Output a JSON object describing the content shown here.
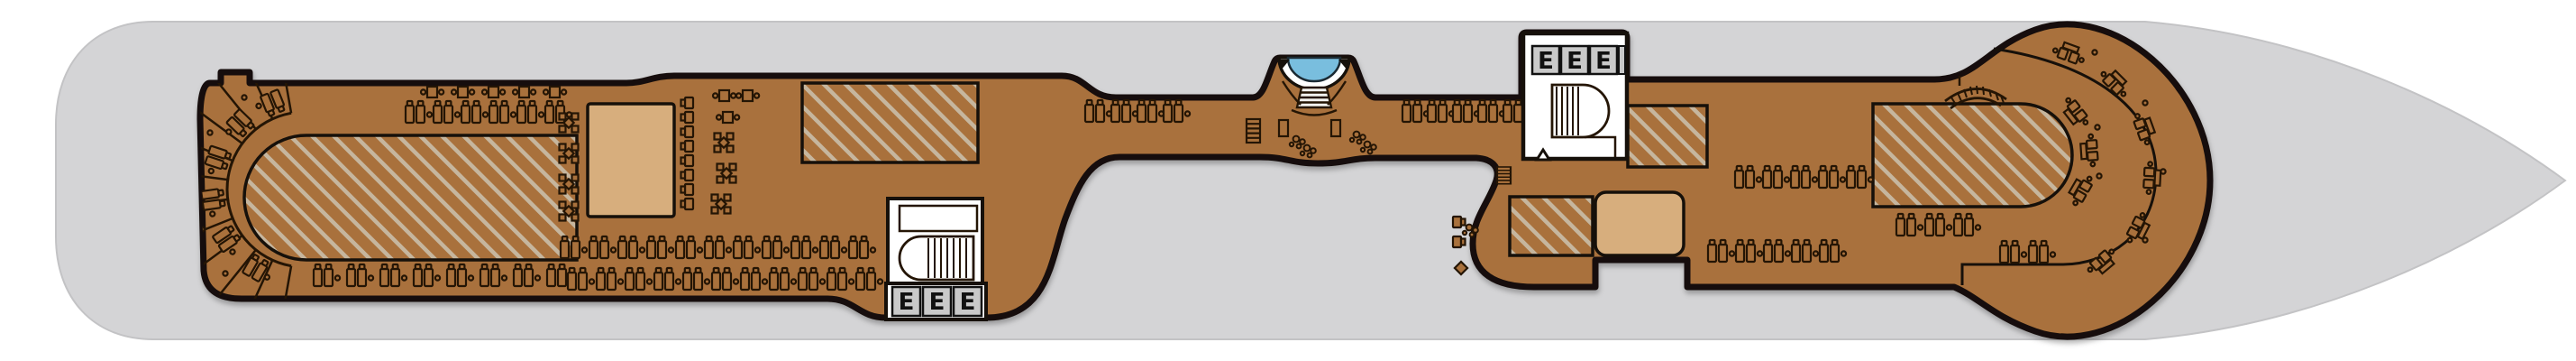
{
  "page": {
    "kind": "cruise-ship-deck-plan",
    "background": "#ffffff"
  },
  "colors": {
    "hull": "#d4d4d6",
    "hull_edge": "#c3c3c5",
    "deck_wood": "#a9713c",
    "deck_outline": "#16100a",
    "hatch_stripe": "#c6b69e",
    "structure_tan": "#d7ae7d",
    "stairwell_white": "#ffffff",
    "elevator_cell": "#c9c9c9",
    "elevator_letter": "#111111",
    "pool_water": "#79bede",
    "pool_rim": "#ffffff",
    "icon_line": "#241505"
  },
  "elevators": {
    "label": "E",
    "banks": [
      {
        "id": "aft-elevator-bank",
        "cells": 3
      },
      {
        "id": "forward-elevator-bank",
        "cells": 3
      }
    ]
  },
  "pool": {
    "shape": "semicircular",
    "has_steps": true
  },
  "counts": {
    "hatched_sun_areas": 6,
    "tan_structures": 2,
    "spiral_stairwells": 2,
    "sun_lounger_rows": 10,
    "fan_step_terraces": 1
  },
  "icon_names": {
    "sun-lounger-pair-icon": "two sunbeds with side-table dots",
    "cafe-table-icon": "table with two chairs",
    "four-seat-table-icon": "table with four chairs",
    "chair-pair-icon": "two chairs with table",
    "spiral-stairs-icon": "stair flight with curved end",
    "ladder-stairs-icon": "straight stair flight",
    "fan-steps-icon": "radial terrace steps",
    "plant-icon": "potted plant",
    "pool-steps-icon": "pool entry steps"
  }
}
